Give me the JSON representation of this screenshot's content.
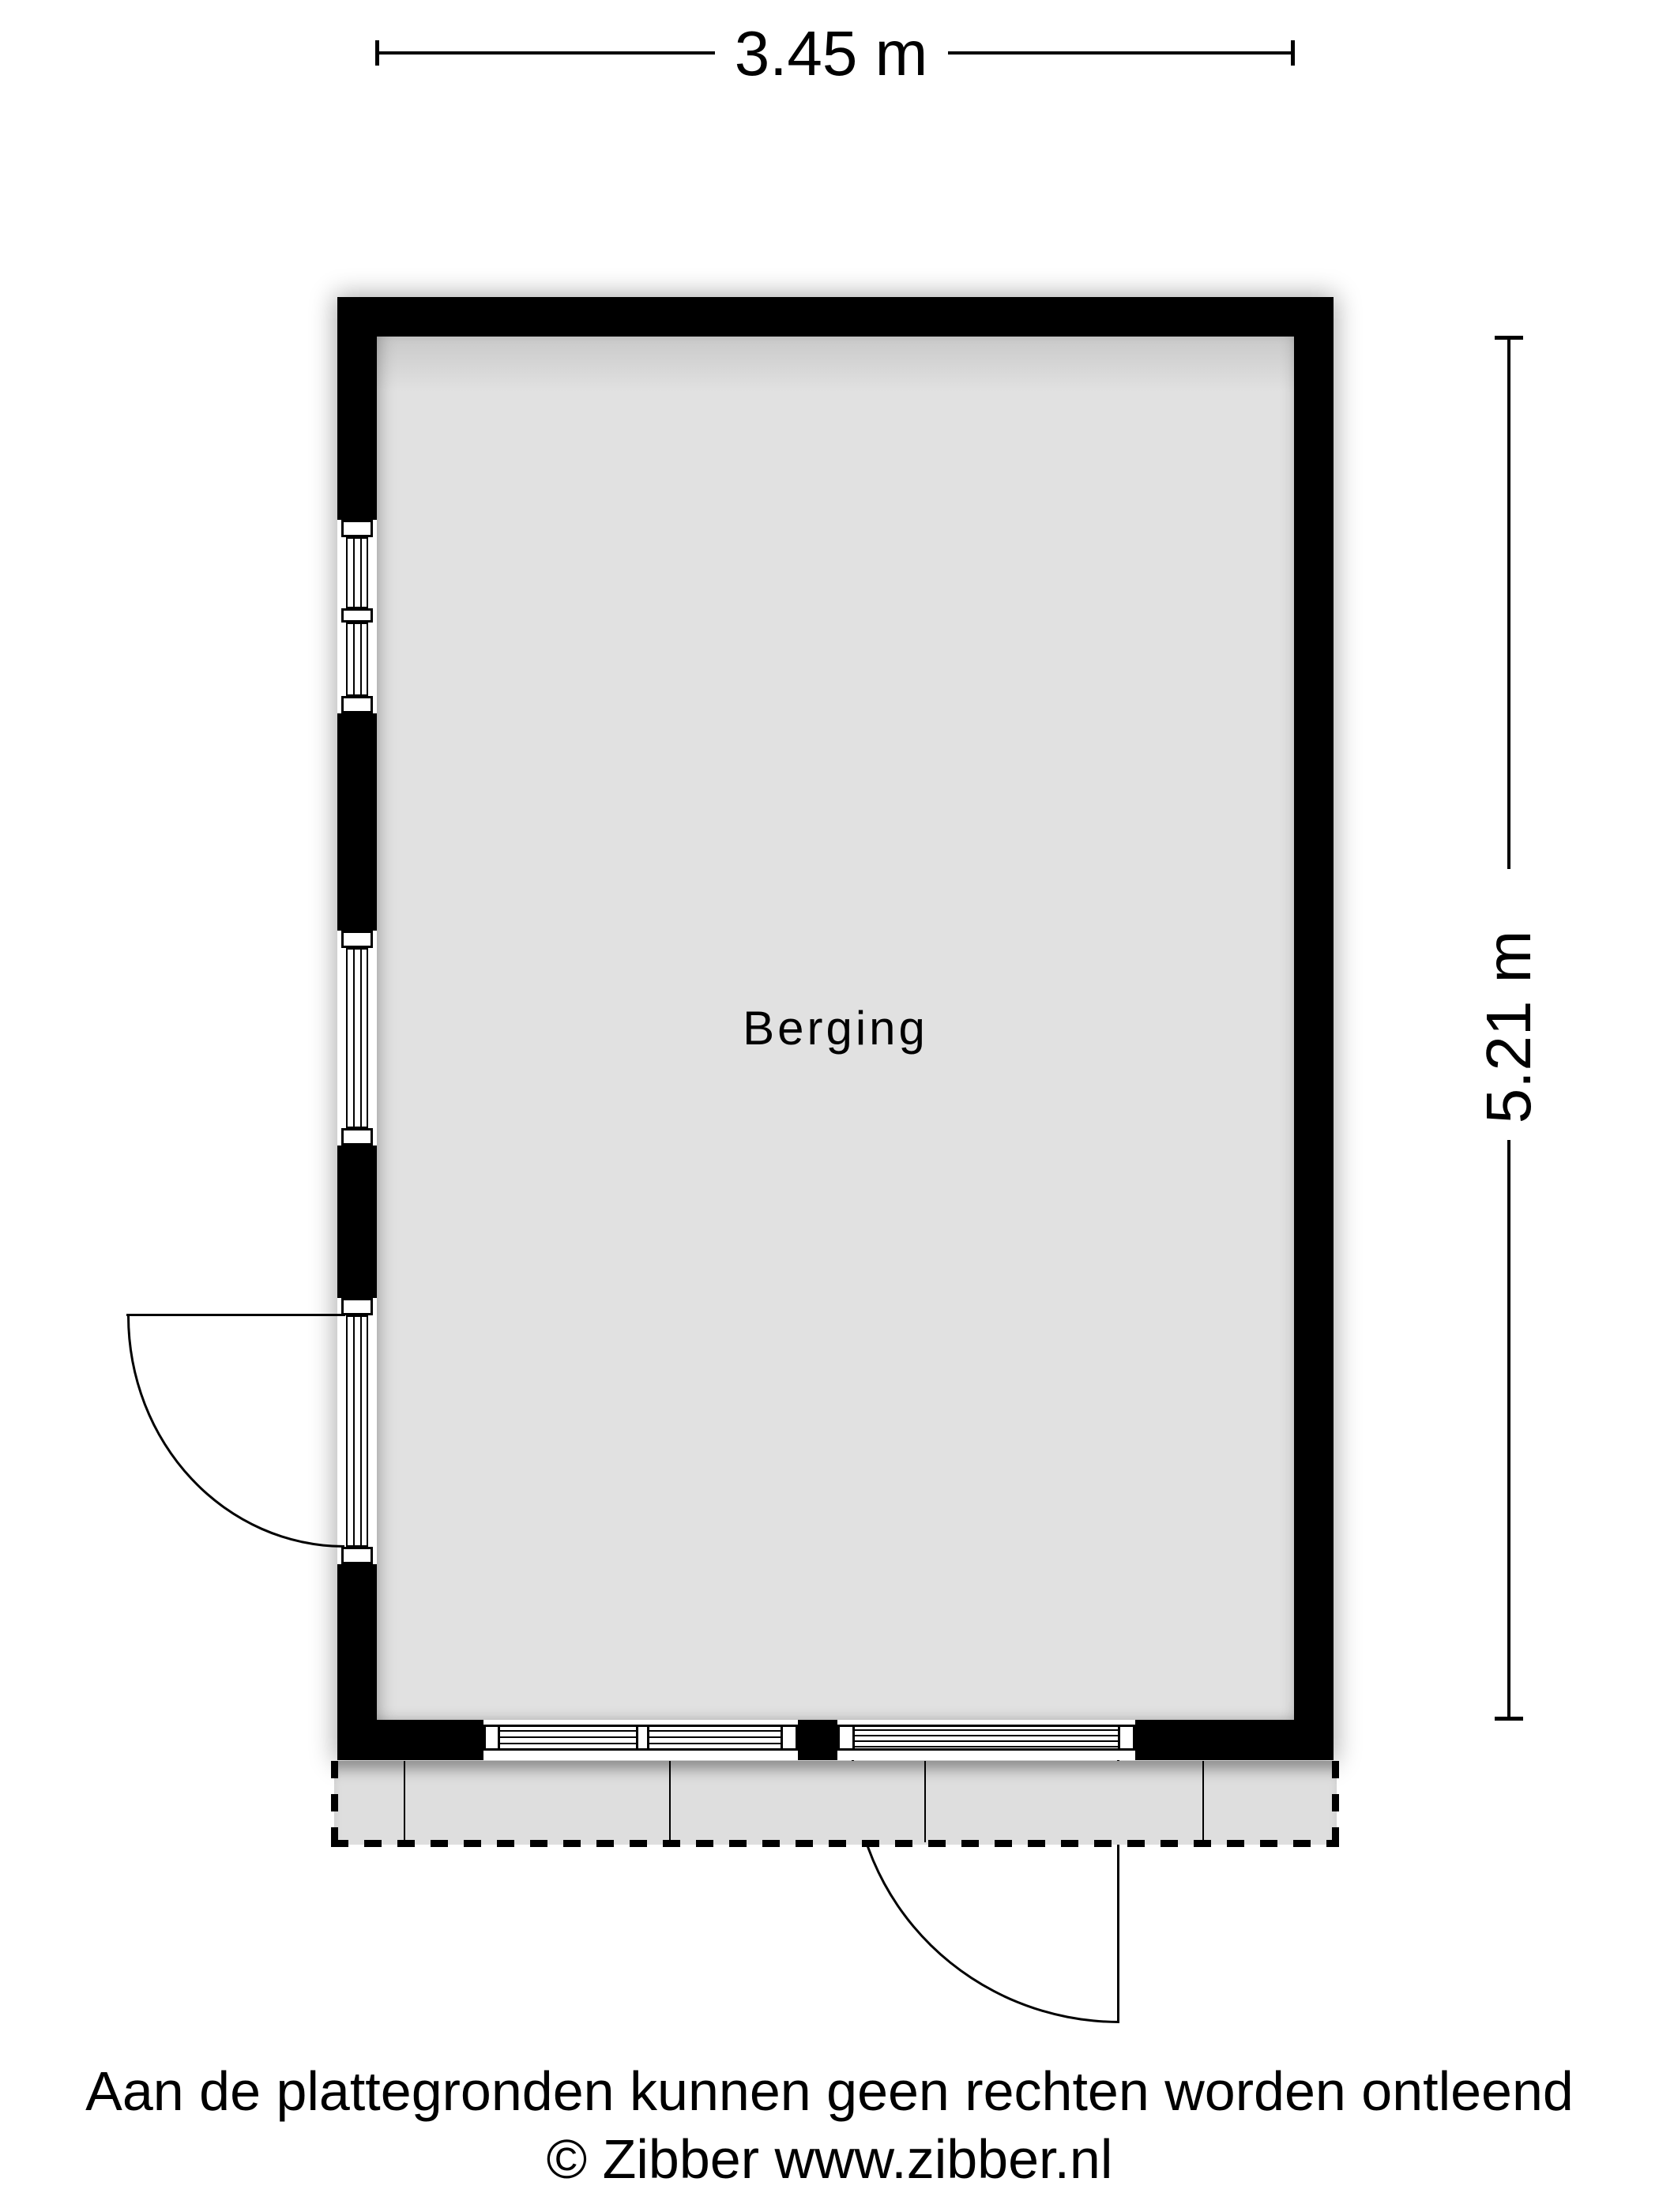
{
  "plan": {
    "room": {
      "label": "Berging"
    },
    "dimensions": {
      "width_label": "3.45 m",
      "height_label": "5.21 m"
    },
    "features": {
      "left_wall": [
        "window-upper",
        "window-lower",
        "door-outswing"
      ],
      "bottom_wall": [
        "window",
        "door-outswing"
      ],
      "terrace": "dashed-paved-area"
    }
  },
  "footer": {
    "disclaimer": "Aan de plattegronden kunnen geen rechten worden ontleend",
    "copyright": "© Zibber www.zibber.nl"
  },
  "colors": {
    "wall": "#000000",
    "floor": "#e0e0e0",
    "terrace": "#dedede",
    "line": "#000000",
    "background": "#ffffff"
  }
}
